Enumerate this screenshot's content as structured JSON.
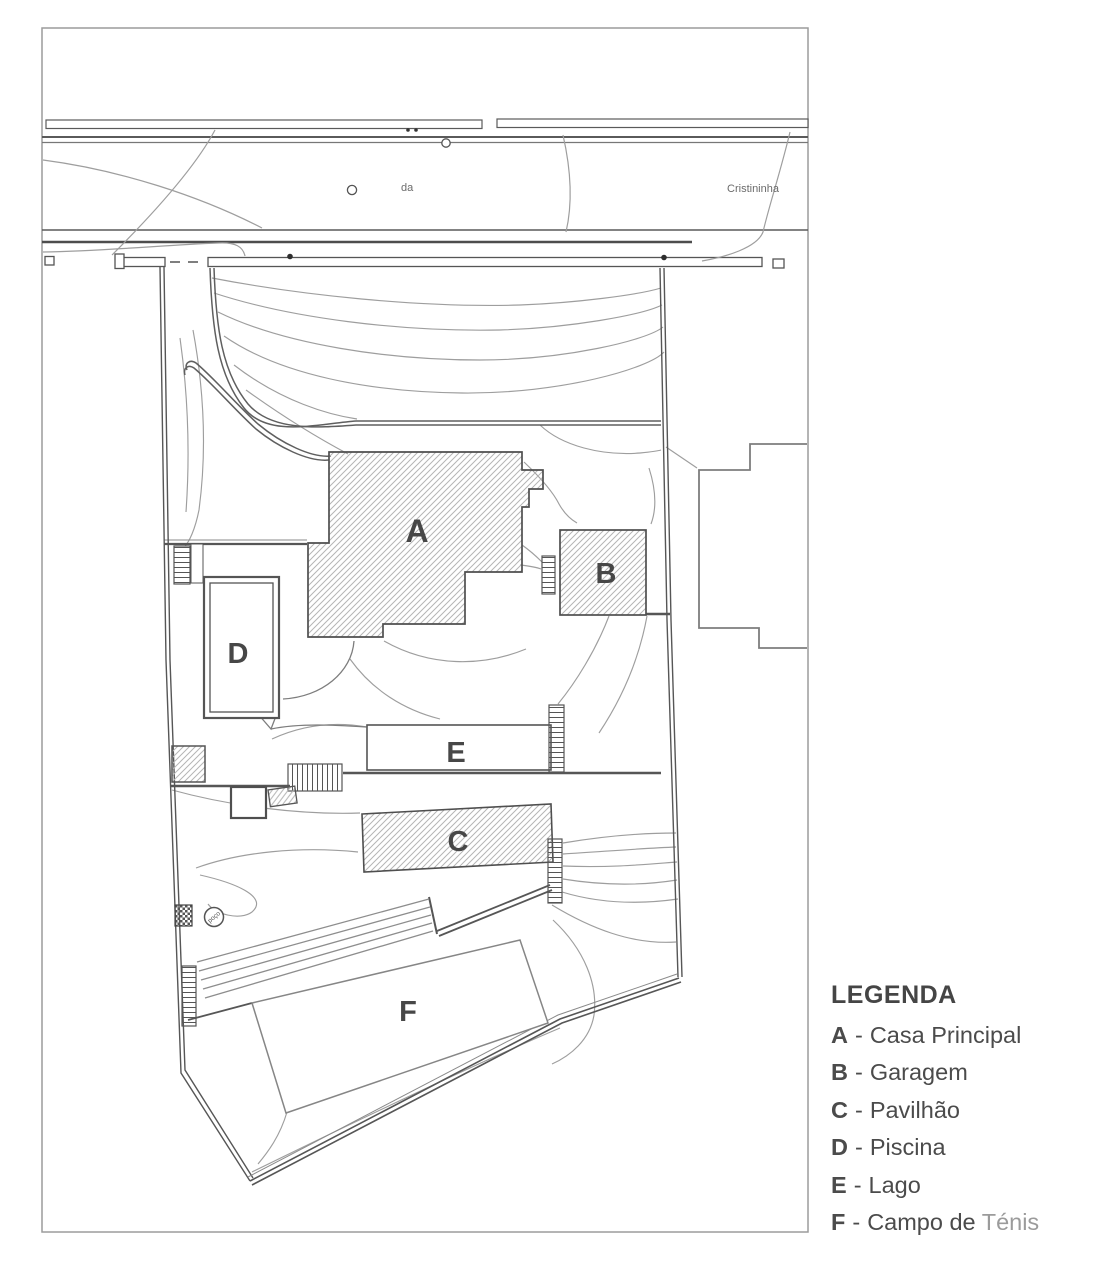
{
  "plan": {
    "building_labels": {
      "a": "A",
      "b": "B",
      "c": "C",
      "d": "D",
      "e": "E",
      "f": "F"
    },
    "road": {
      "street_fragment": "da",
      "street_name": "Cristininha"
    },
    "well_label": "poço"
  },
  "legend": {
    "title": "LEGENDA",
    "separator": "-",
    "items": [
      {
        "key": "A",
        "name": "Casa Principal"
      },
      {
        "key": "B",
        "name": "Garagem"
      },
      {
        "key": "C",
        "name": "Pavilhão"
      },
      {
        "key": "D",
        "name": "Piscina"
      },
      {
        "key": "E",
        "name": "Lago"
      },
      {
        "key": "F",
        "name": "Campo de ",
        "name_suffix": "Ténis"
      }
    ]
  },
  "colors": {
    "ink": "#4b4b4b",
    "muted_text": "#9b9b9b",
    "contour": "#9e9e9e",
    "frame": "#9c9c9c",
    "hatch": "#b5b5b5"
  }
}
